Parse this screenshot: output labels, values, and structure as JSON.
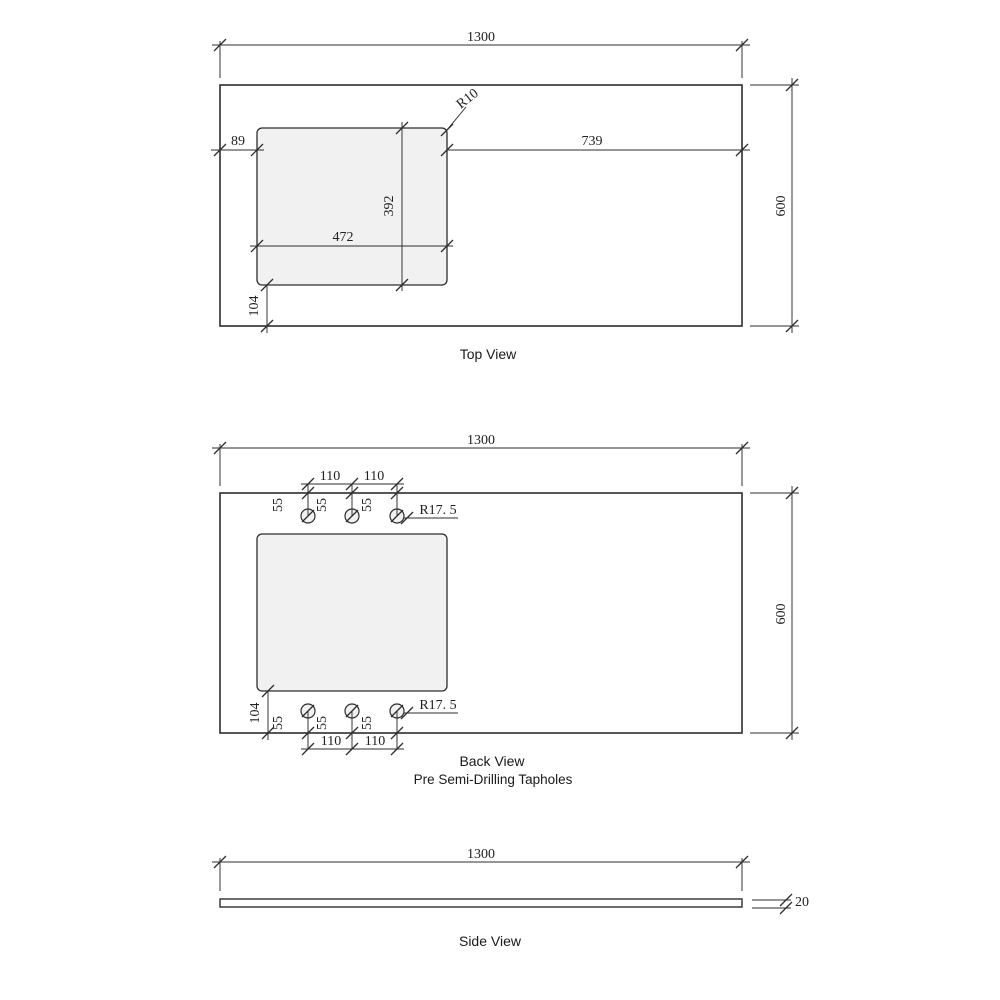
{
  "colors": {
    "line": "#2d2d2d",
    "fill": "#f1f1f1",
    "background": "#ffffff"
  },
  "views": {
    "top": {
      "label": "Top View",
      "dim_width": "1300",
      "dim_height": "600",
      "dim_left_to_cutout": "89",
      "dim_cutout_to_right": "739",
      "dim_cutout_width": "472",
      "dim_cutout_height": "392",
      "dim_cutout_to_bottom": "104",
      "cutout_corner_radius": "R10"
    },
    "back": {
      "label": "Back View",
      "sublabel": "Pre Semi-Drilling Tapholes",
      "dim_width": "1300",
      "dim_height": "600",
      "dim_hole_pitch": "110",
      "dim_hole_edge_offset": "55",
      "hole_radius": "R17. 5",
      "dim_cutout_to_bottom": "104"
    },
    "side": {
      "label": "Side View",
      "dim_width": "1300",
      "dim_thickness": "20"
    }
  }
}
